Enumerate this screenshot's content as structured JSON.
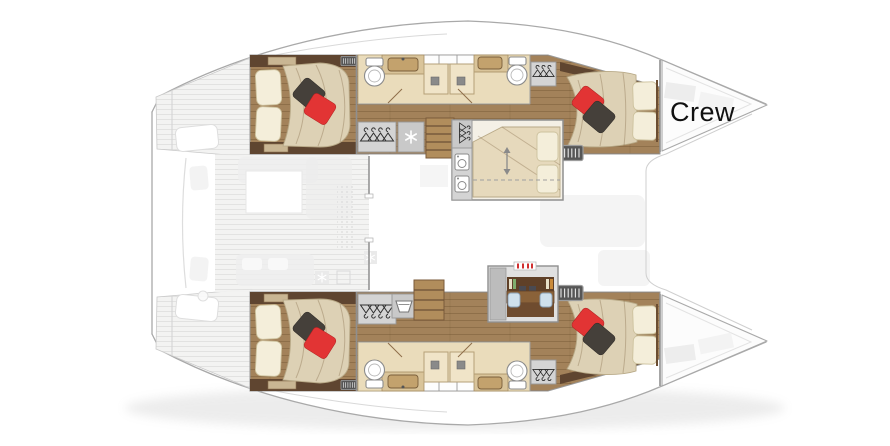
{
  "document": {
    "type": "catamaran-deck-plan",
    "description": "Top-down interior layout plan of a sailing catamaran, bow pointing right"
  },
  "labels": {
    "crew_area": "Crew"
  },
  "colors": {
    "background": "#ffffff",
    "hull_outline": "#a9a9a9",
    "wood_floor": "#a3825a",
    "dark_cabinet": "#5f4530",
    "bathroom_floor": "#eadcbb",
    "mattress": "#ddd1b5",
    "pillow_cream": "#f4eeda",
    "pillow_red": "#e23434",
    "pillow_dark": "#45403a",
    "locker_gray": "#d4d4d4",
    "stairs_wood": "#b18d5c",
    "desk_brown": "#8a6239",
    "chair_blue": "#cfe0ec",
    "label_text": "#111111"
  },
  "areas": {
    "port_hull": [
      "aft-double-cabin",
      "bathroom",
      "twin-showers",
      "hanging-locker",
      "freezer",
      "stairs",
      "forepeak-cabin",
      "forward-double-cabin"
    ],
    "starboard_hull": [
      "aft-double-cabin",
      "bathroom",
      "twin-showers",
      "hanging-locker",
      "laundry-tub",
      "shelves",
      "desk-office",
      "forward-double-cabin"
    ],
    "bow": [
      "crew-area",
      "foredeck"
    ],
    "stern": [
      "swim-platforms",
      "cockpit-ghost"
    ],
    "bridgedeck": [
      "saloon-ghost"
    ]
  },
  "icons": {
    "hanging_locker": "hanger-icon",
    "freezer": "snowflake-icon",
    "washer": "washer-icon",
    "laundry_tub": "tub-icon",
    "convertible_berth": "up-down-arrow-icon",
    "vent": "grille-icon"
  }
}
